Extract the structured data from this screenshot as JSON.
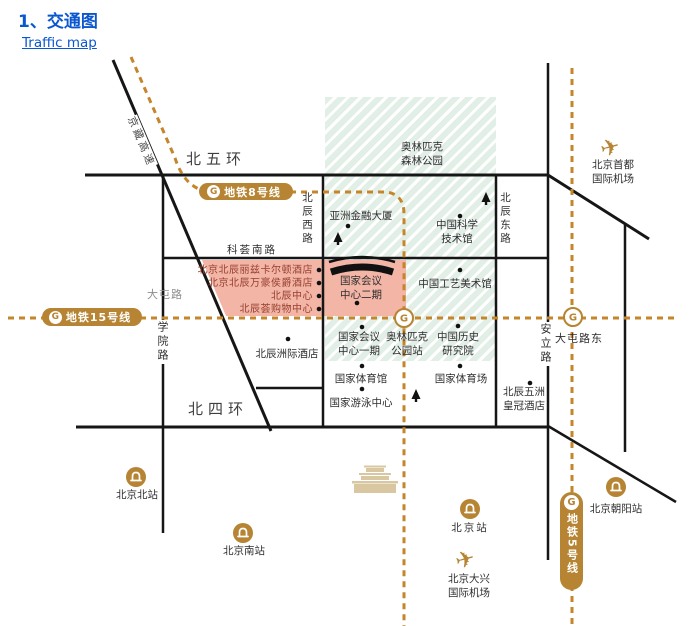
{
  "page": {
    "title": "1、交通图",
    "subtitle_link": "Traffic map"
  },
  "metro": {
    "line8": "地铁8号线",
    "line15": "地铁15号线",
    "line5": "地铁5号线",
    "logo": "G"
  },
  "roads": {
    "n5": "北五环",
    "n4": "北四环",
    "kehui": "科荟南路",
    "jingzang": "京藏高速",
    "xueyuan": "学院路",
    "datun": "大屯路",
    "datundong": "大屯路东",
    "anli": "安立路",
    "beichen_w": "北辰西路",
    "beichen_e": "北辰东路"
  },
  "areas": {
    "forest_l1": "奥林匹克",
    "forest_l2": "森林公园"
  },
  "pois": {
    "asia_financial": "亚洲金融大厦",
    "cstm_l1": "中国科学",
    "cstm_l2": "技术馆",
    "arts": "中国工艺美术馆",
    "ncc2_l1": "国家会议",
    "ncc2_l2": "中心二期",
    "ncc1_l1": "国家会议",
    "ncc1_l2": "中心一期",
    "oly_station_l1": "奥林匹克",
    "oly_station_l2": "公园站",
    "history_l1": "中国历史",
    "history_l2": "研究院",
    "gym": "国家体育馆",
    "stadium": "国家体育场",
    "aquatics": "国家游泳中心",
    "intercontinental": "北辰洲际酒店",
    "crowne_l1": "北辰五洲",
    "crowne_l2": "皇冠酒店"
  },
  "hotels": {
    "ritz": "北京北辰丽兹卡尔顿酒店",
    "marriott": "北京北辰万豪侯爵酒店",
    "center": "北辰中心",
    "mall": "北辰荟购物中心"
  },
  "stations": {
    "north": "北京北站",
    "south": "北京南站",
    "main": "北京站",
    "chaoyang": "北京朝阳站"
  },
  "airports": {
    "capital_l1": "北京首都",
    "capital_l2": "国际机场",
    "daxing_l1": "北京大兴",
    "daxing_l2": "国际机场"
  },
  "icons": {
    "plane": "✈"
  },
  "colors": {
    "accent_blue": "#0b57d0",
    "metro_gold": "#b68432",
    "metro_line": "#c5862b",
    "park_green": "#e2efe7",
    "pink": "#f3b5a6",
    "hotel_text": "#96402f"
  }
}
